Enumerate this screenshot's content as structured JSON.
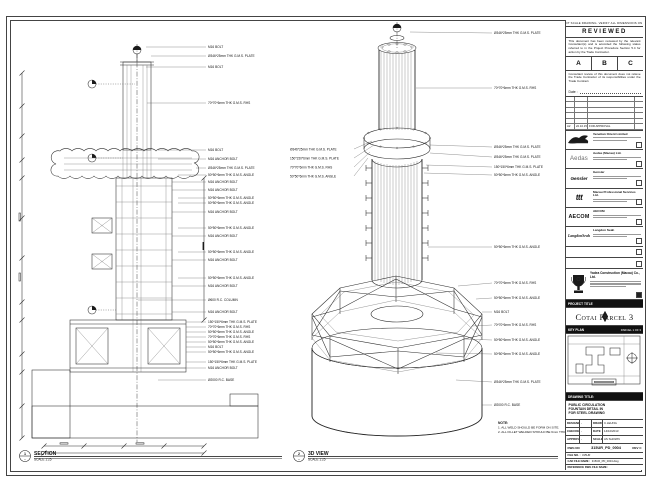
{
  "sheet": {
    "disclaimer": "DO NOT SCALE DRAWING. VERIFY ALL DIMENSIONS ON SITE."
  },
  "review": {
    "title": "REVIEWED",
    "para1": "This document has been reviewed by the relevant Consultant(s) and is accorded the following status referred to in the Project Procedure Section 5.4 for action by the Trade Contractor.",
    "statuses": [
      "A",
      "B",
      "C"
    ],
    "para2": "Consultant review of this document does not relieve the Trade Contractor of its responsibilities under the Trade Contract.",
    "date_label": "Date :"
  },
  "rev_table": {
    "row": {
      "rev": "A2",
      "date": "22.10.15",
      "desc": "FOR APPROVAL",
      "by": ""
    }
  },
  "consultants": [
    {
      "logo_text": "",
      "name": "Venetian Orient Limited"
    },
    {
      "logo_text": "Aedas",
      "name": "Aedas (Macau) Ltd."
    },
    {
      "logo_text": "Gensler",
      "name": "Gensler"
    },
    {
      "logo_text": "ttt",
      "name": "Macau Professional Services Ltd."
    },
    {
      "logo_text": "AECOM",
      "name": "AECOM"
    },
    {
      "logo_text": "LangdonSeah",
      "name": "Langdon Seah"
    }
  ],
  "contractor": {
    "name": "Yadea Construction (Macau) Co., Ltd."
  },
  "project": {
    "label": "PROJECT TITLE",
    "title": "Cotai Parcel 3"
  },
  "key_plan": {
    "label": "KEY PLAN",
    "right_label": "PARCEL 1 OF 3"
  },
  "title_block": {
    "label": "DRAWING TITLE:",
    "lines": [
      "PUBLIC CIRCULATION",
      "FOUNTAIN DETAIL IN",
      "FOR STEEL DRAWING"
    ],
    "fields": {
      "designed_l": "DESIGNED",
      "designed_v": "-",
      "drawn_l": "DRAWN",
      "drawn_v": "C.LEUNG",
      "checked_l": "CHECKED",
      "checked_v": "-",
      "date_l": "DATE",
      "date_v": "14/10/2013",
      "approved_l": "APPROVED",
      "approved_v": "-",
      "scale_l": "SCALE",
      "scale_v": "AS SHOWN"
    },
    "dwg_label": "DWG NO",
    "dwg_no": "315UR_PD_0004",
    "rev": "REV C",
    "file_no_label": "FILE NO. :",
    "file_no": "315UR",
    "cad_label": "CAD FILE NAME :",
    "cad_value": "315UR_PD_0004.dwg",
    "ref_label": "REFERENCE DWG FILE NAME :"
  },
  "left_view": {
    "bubble_no": "1",
    "bubble_ref": "-",
    "title": "SECTION",
    "scale": "SCALE 1:25",
    "annotations": [
      "M16 BOLT",
      "Ø346*25mm THK G.M.S. PLATE",
      "M16 BOLT",
      "70*70*6mm THK G.M.S. RHS",
      "M16 BOLT",
      "M16 ANCHOR BOLT",
      "Ø346*25mm THK G.M.S. PLATE",
      "50*50*6mm THK G.M.S. ANGLE",
      "M16 ANCHOR BOLT",
      "M16 ANCHOR BOLT",
      "50*50*6mm THK G.M.S. ANGLE",
      "50*50*6mm THK G.M.S. ANGLE",
      "M16 ANCHOR BOLT",
      "50*50*6mm THK G.M.S. ANGLE",
      "M16 ANCHOR BOLT",
      "50*50*6mm THK G.M.S. ANGLE",
      "M16 ANCHOR BOLT",
      "50*50*6mm THK G.M.S. ANGLE",
      "M16 ANCHOR BOLT",
      "Ø600 R.C. COLUMN",
      "M16 ANCHOR BOLT",
      "150*150*6mm THK G.M.S. PLATE",
      "70*70*6mm THK G.M.S. RHS",
      "50*50*6mm THK G.M.S. ANGLE",
      "70*70*6mm THK G.M.S. RHS",
      "50*50*6mm THK G.M.S. ANGLE",
      "M16 BOLT",
      "50*50*6mm THK G.M.S. ANGLE",
      "150*150*6mm THK G.M.S. PLATE",
      "M16 ANCHOR BOLT",
      "Ø2000 R.C. BASE"
    ]
  },
  "right_view": {
    "bubble_no": "2",
    "bubble_ref": "-",
    "title": "3D VIEW",
    "scale": "SCALE 1:25",
    "annotations_right": [
      "Ø346*25mm THK G.M.S. PLATE",
      "70*70*6mm THK G.M.S. RHS",
      "Ø346*25mm THK G.M.S. PLATE",
      "Ø346*25mm THK G.M.S. PLATE",
      "150*150*6mm THK G.M.S. PLATE",
      "50*50*6mm THK G.M.S. ANGLE",
      "50*50*6mm THK G.M.S. ANGLE",
      "70*70*6mm THK G.M.S. RHS",
      "50*50*6mm THK G.M.S. ANGLE",
      "M16 BOLT",
      "70*70*6mm THK G.M.S. RHS",
      "50*50*6mm THK G.M.S. ANGLE",
      "50*50*6mm THK G.M.S. ANGLE",
      "Ø346*25mm THK G.M.S. PLATE",
      "Ø2000 R.C. BASE"
    ],
    "annotations_left": [
      "Ø346*25mm THK G.M.S. PLATE",
      "150*150*6mm THK G.M.S. PLATE",
      "70*70*6mm THK G.M.S. RHS",
      "50*50*6mm THK G.M.S. ANGLE"
    ],
    "note": {
      "heading": "NOTE:",
      "line1": "1. ALL WELD SHOULD BE FORM ON SITE.",
      "line2": "2. ALL FILLET WELDED SHOULD BE 6mm THK."
    }
  }
}
